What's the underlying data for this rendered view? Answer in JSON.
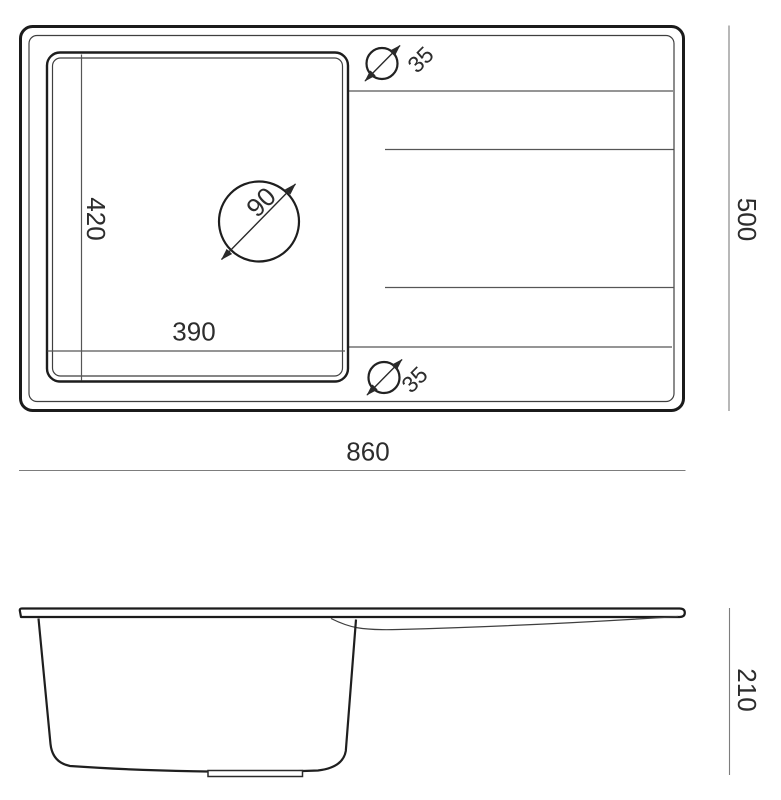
{
  "drawing": {
    "type": "technical-drawing",
    "subject": "kitchen sink with single basin and drainboard",
    "background": "#ffffff",
    "colors": {
      "outline": "#1b1b1b",
      "detail_line": "#565656",
      "dimension_line": "#7d7d7d",
      "text": "#2d2d2d"
    },
    "top_view": {
      "name": "top view",
      "dimensions": {
        "overall_width": {
          "value": 860,
          "label": "860"
        },
        "overall_depth": {
          "value": 500,
          "label": "500"
        },
        "basin_width": {
          "value": 390,
          "label": "390"
        },
        "basin_depth": {
          "value": 420,
          "label": "420"
        },
        "drain_hole_diameter": {
          "value": 90,
          "label": "90"
        },
        "tap_hole_top_diameter": {
          "value": 35,
          "label": "35"
        },
        "tap_hole_bottom_diameter": {
          "value": 35,
          "label": "35"
        }
      }
    },
    "side_view": {
      "name": "side view",
      "dimensions": {
        "overall_height": {
          "value": 210,
          "label": "210"
        }
      }
    }
  }
}
